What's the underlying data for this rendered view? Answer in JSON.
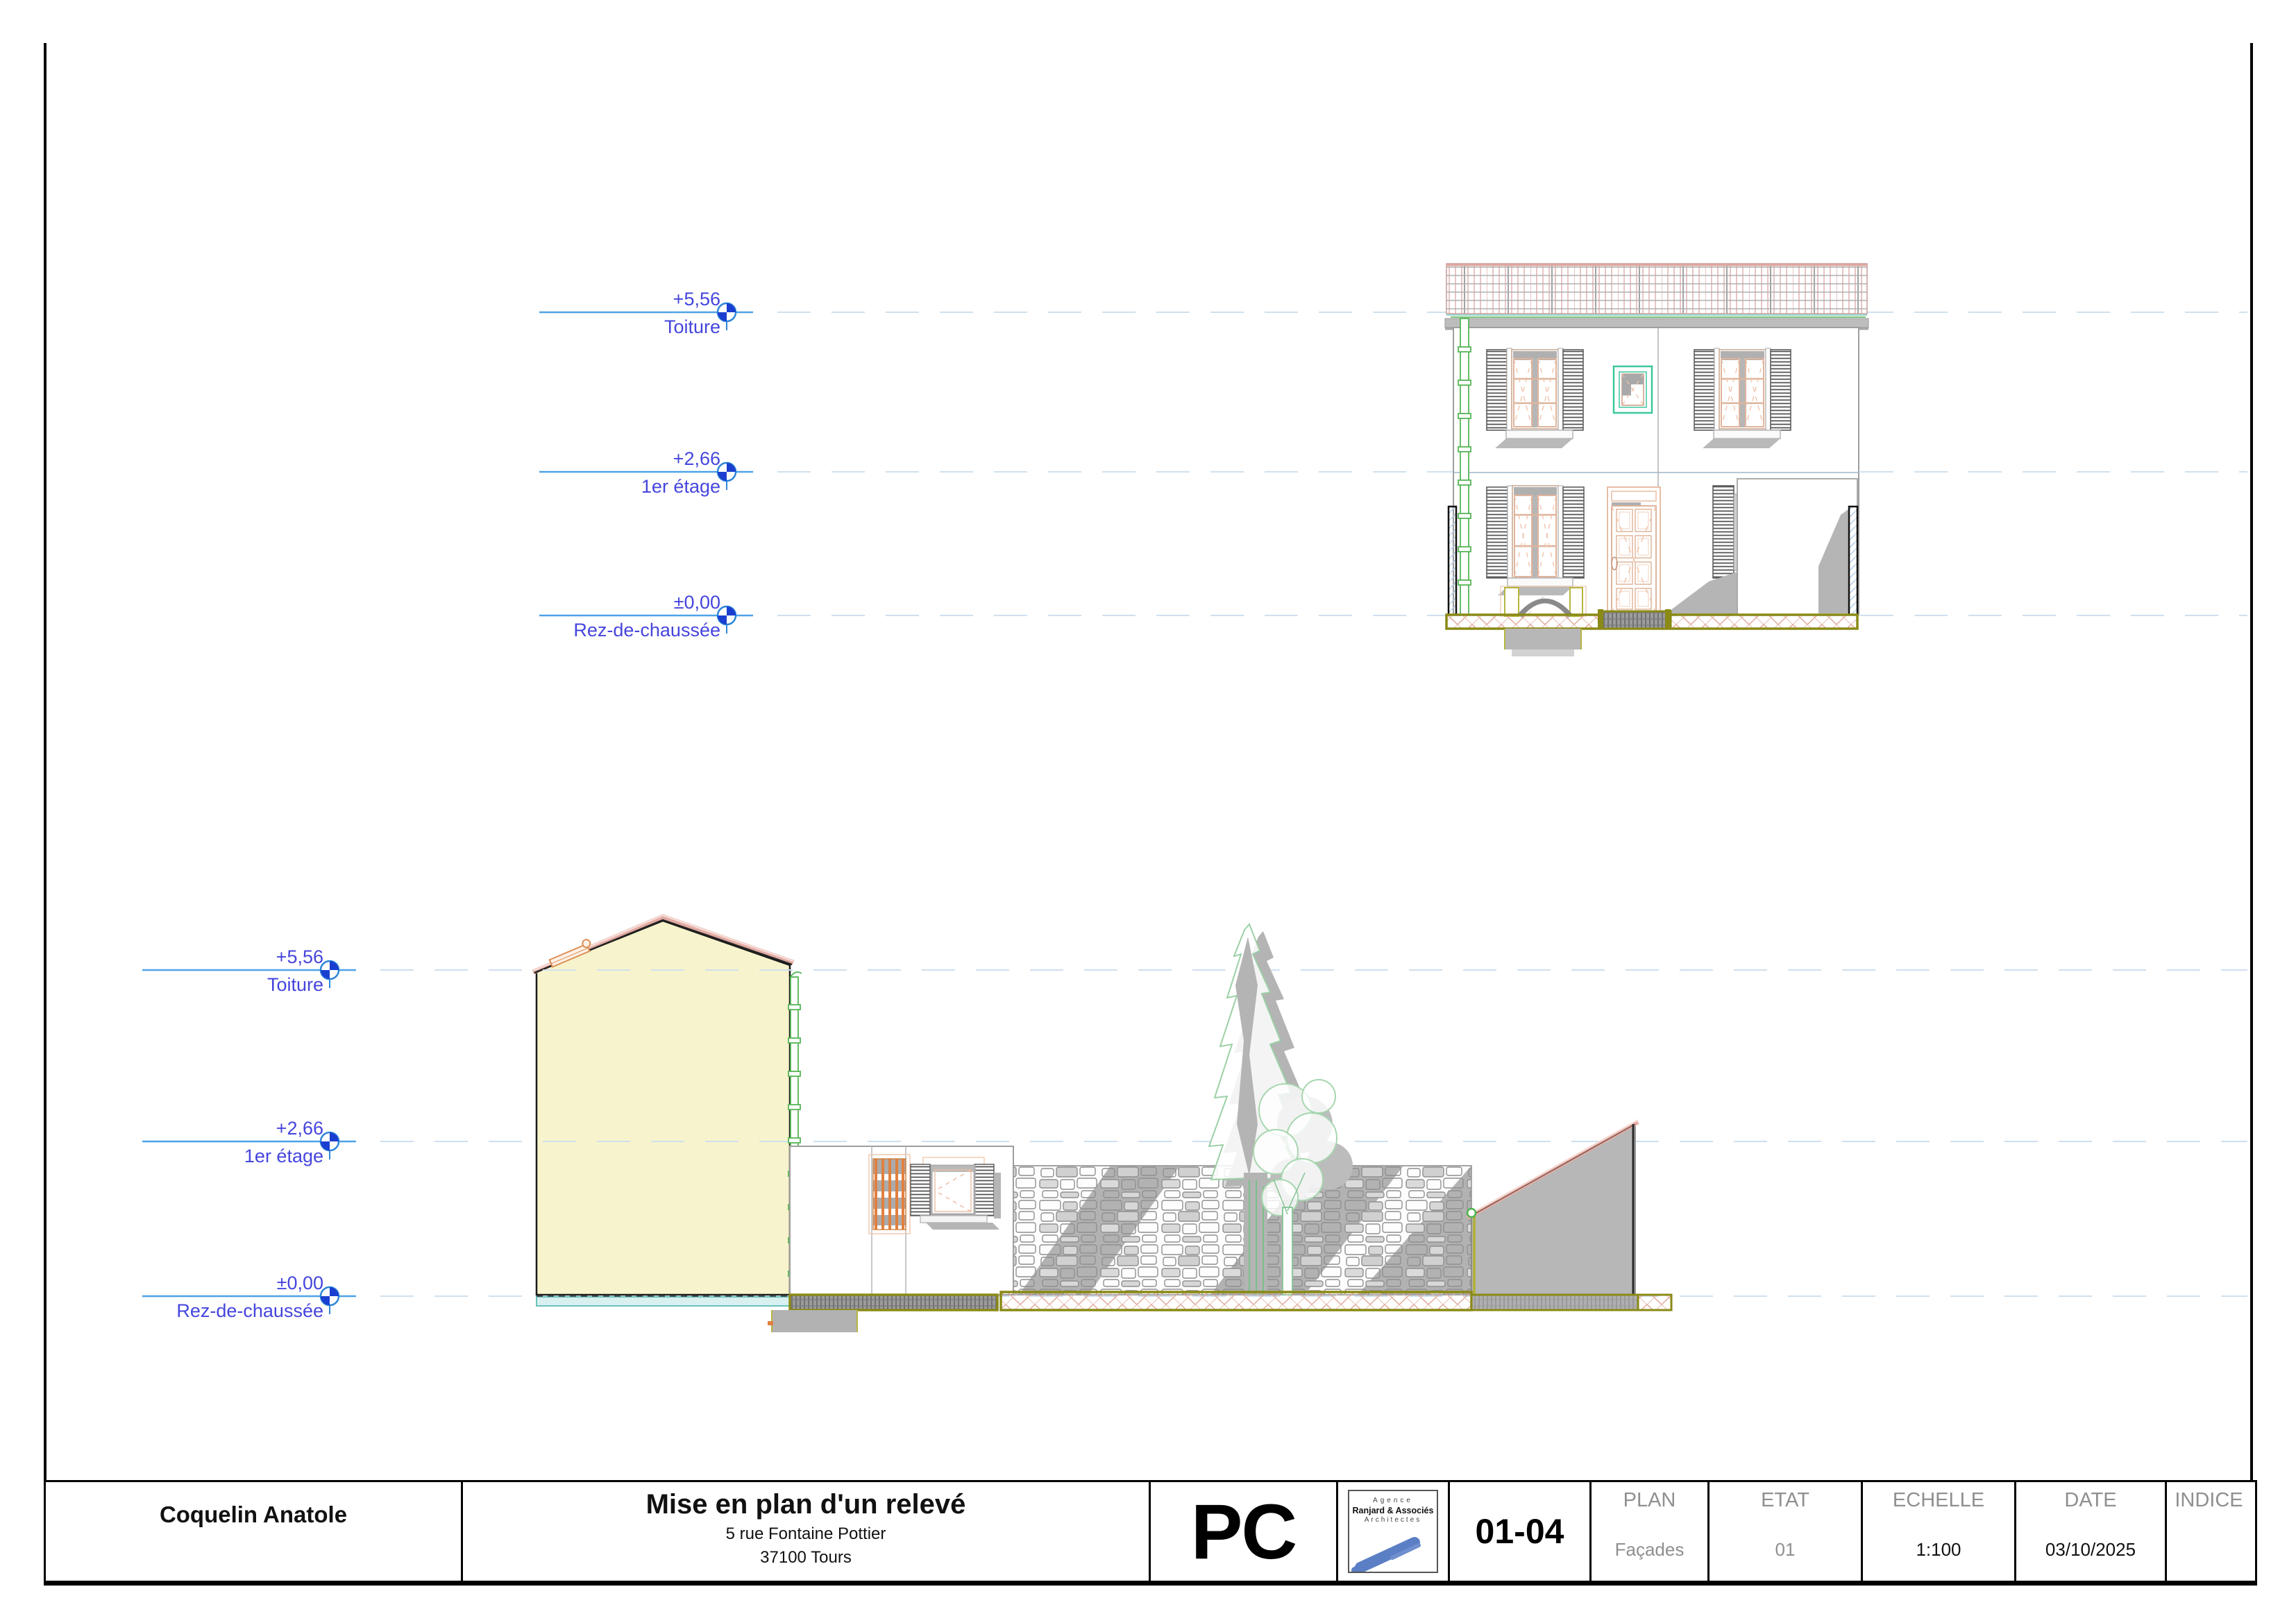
{
  "document": {
    "type": "architectural elevation sheet",
    "drawing_views": [
      "Façade avant (élévation)",
      "Façade / coupe sur cour"
    ]
  },
  "levels": {
    "values": [
      {
        "value": "+5,56",
        "label": "Toiture"
      },
      {
        "value": "+2,66",
        "label": "1er étage"
      },
      {
        "value": "±0,00",
        "label": "Rez-de-chaussée"
      }
    ]
  },
  "title_block": {
    "client": "Coquelin Anatole",
    "project_title": "Mise en plan d'un relevé",
    "address_line1": "5 rue Fontaine Pottier",
    "address_line2": "37100 Tours",
    "permit_code": "PC",
    "logo": {
      "line1": "Agence",
      "line2": "Ranjard & Associés",
      "line3": "Architectes"
    },
    "sheet_number": "01-04",
    "columns": [
      {
        "label": "PLAN",
        "value": "Façades"
      },
      {
        "label": "ETAT",
        "value": "01"
      },
      {
        "label": "ECHELLE",
        "value": "1:100"
      },
      {
        "label": "DATE",
        "value": "03/10/2025"
      },
      {
        "label": "INDICE",
        "value": ""
      }
    ]
  },
  "colors": {
    "level_text": "#4545dd",
    "level_line": "#4da3e8",
    "level_dash": "#cfe0ee",
    "gable_wall_fill": "#f7f3cc",
    "roof_cap_pink": "#e2aaa2",
    "downpipe_green": "#55b555",
    "ground_band_olive": "#8a8a16",
    "hatch_red": "#e0a090",
    "teal_window": "#3cc89e",
    "joinery_peach": "#e2b49c",
    "shadow_gray": "#b5b5b5",
    "logo_blue": "#5b7fc4"
  }
}
